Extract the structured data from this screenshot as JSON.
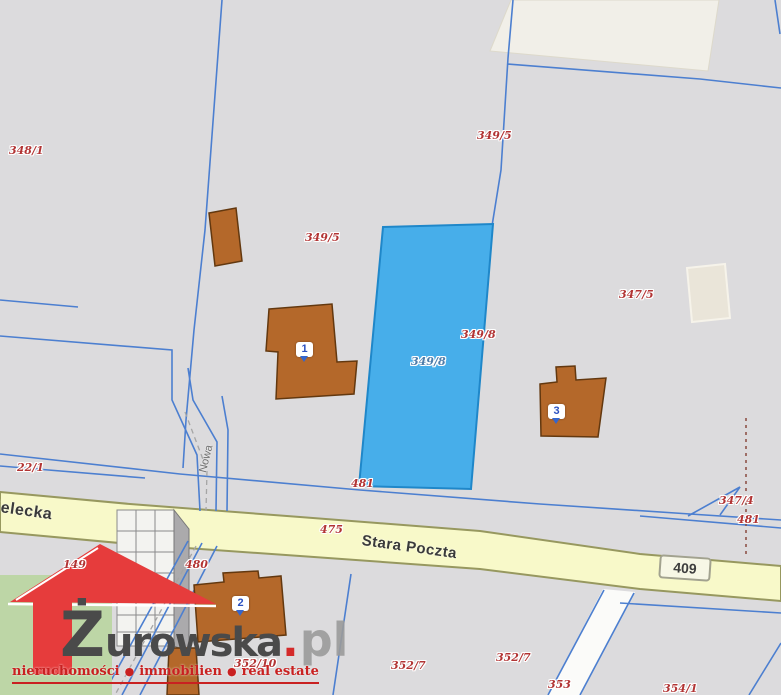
{
  "map": {
    "route_badge": "409",
    "streets": {
      "sielecka": "Sielecka",
      "stara_poczta": "Stara Poczta",
      "nowa": "Nowa"
    },
    "parcel_labels": [
      {
        "text": "348/1"
      },
      {
        "text": "349/5"
      },
      {
        "text": "349/5"
      },
      {
        "text": "349/8"
      },
      {
        "text": "349/8"
      },
      {
        "text": "347/5"
      },
      {
        "text": "22/1"
      },
      {
        "text": "481"
      },
      {
        "text": "475"
      },
      {
        "text": "347/4"
      },
      {
        "text": "481"
      },
      {
        "text": "149"
      },
      {
        "text": "480"
      },
      {
        "text": "352/10"
      },
      {
        "text": "352/7"
      },
      {
        "text": "352/7"
      },
      {
        "text": "353"
      },
      {
        "text": "354/1"
      }
    ],
    "building_markers": [
      {
        "number": "1"
      },
      {
        "number": "2"
      },
      {
        "number": "3"
      }
    ],
    "colors": {
      "background": "#dcdbdd",
      "highlighted_parcel": "#47aeea",
      "building": "#b4682a",
      "road_fill": "#f8f9c9",
      "boundary_line": "#4c7fd0",
      "parcel_label": "#b23434"
    }
  },
  "watermark": {
    "brand_initial": "Ż",
    "brand_rest": "urowska",
    "brand_dot": ".",
    "brand_tld": "pl",
    "bullet": "●",
    "tagline": [
      {
        "text": "nieruchomości"
      },
      {
        "text": "immobilien"
      },
      {
        "text": "real estate"
      }
    ],
    "logo_red": "#e63c3c",
    "tagline_red": "#c92121"
  }
}
